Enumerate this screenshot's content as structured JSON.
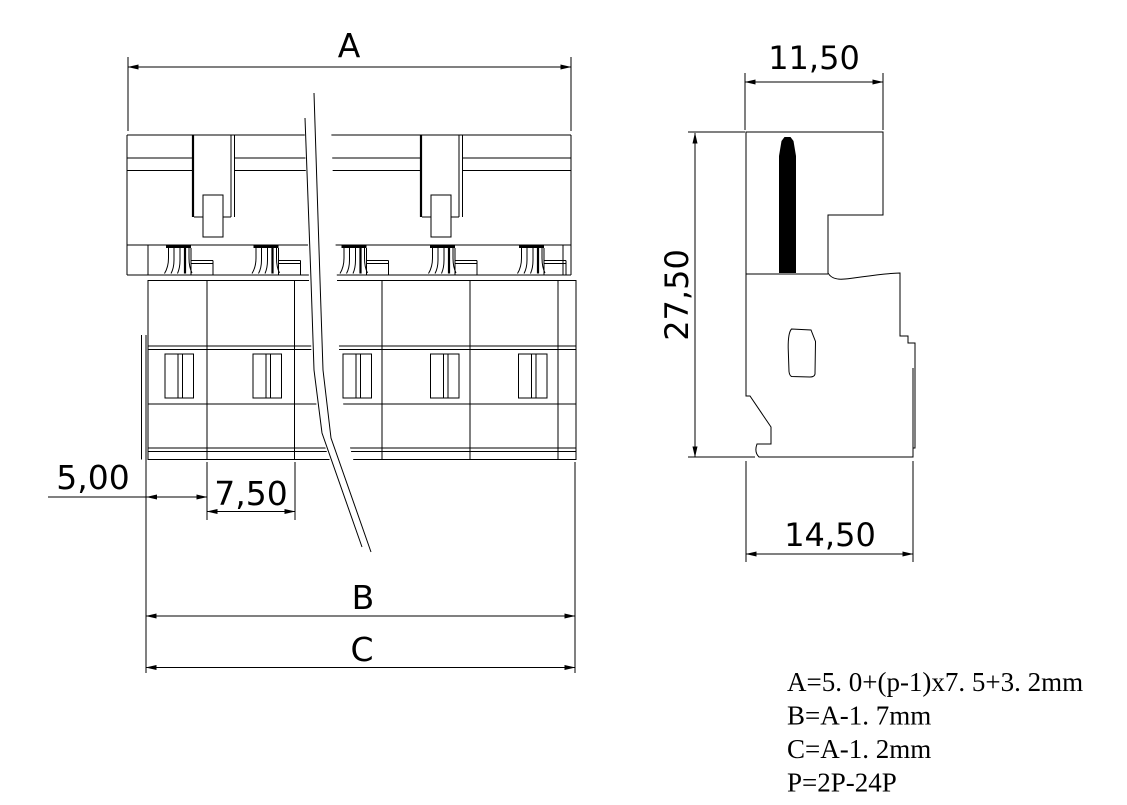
{
  "front_view": {
    "overall_width_label": "A",
    "first_pitch_label": "5,00",
    "pitch_label": "7,50",
    "width_b_label": "B",
    "width_c_label": "C"
  },
  "side_view": {
    "top_width_label": "11,50",
    "height_label": "27,50",
    "bottom_width_label": "14,50"
  },
  "formulas": {
    "a": "A=5. 0+(p-1)x7. 5+3. 2mm",
    "b": "B=A-1. 7mm",
    "c": "C=A-1. 2mm",
    "p": "P=2P-24P"
  },
  "colors": {
    "line": "#000000",
    "background": "#ffffff"
  }
}
